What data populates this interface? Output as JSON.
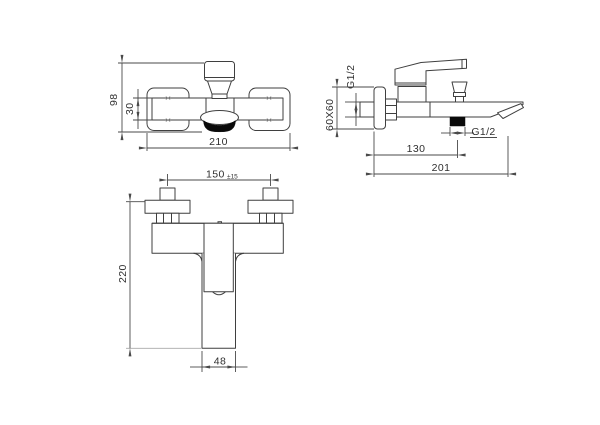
{
  "drawing": {
    "type": "faucet-technical-drawing",
    "colors": {
      "line": "#3f3f3f",
      "dim_line": "#4a4a4a",
      "text": "#2f2f2f",
      "solid_fill": "#0a0a0a",
      "background": "#ffffff"
    },
    "front_view": {
      "dim_height": "98",
      "dim_body_height": "30",
      "dim_width": "210"
    },
    "side_view": {
      "dim_wall_thread": "G1/2",
      "dim_flange": "60X60",
      "dim_outlet_offset": "130",
      "dim_projection": "201",
      "dim_outlet_thread": "G1/2"
    },
    "plan_view": {
      "dim_centers": "150",
      "dim_centers_tolerance": "±15",
      "dim_depth": "220",
      "dim_spout_width": "48"
    }
  }
}
